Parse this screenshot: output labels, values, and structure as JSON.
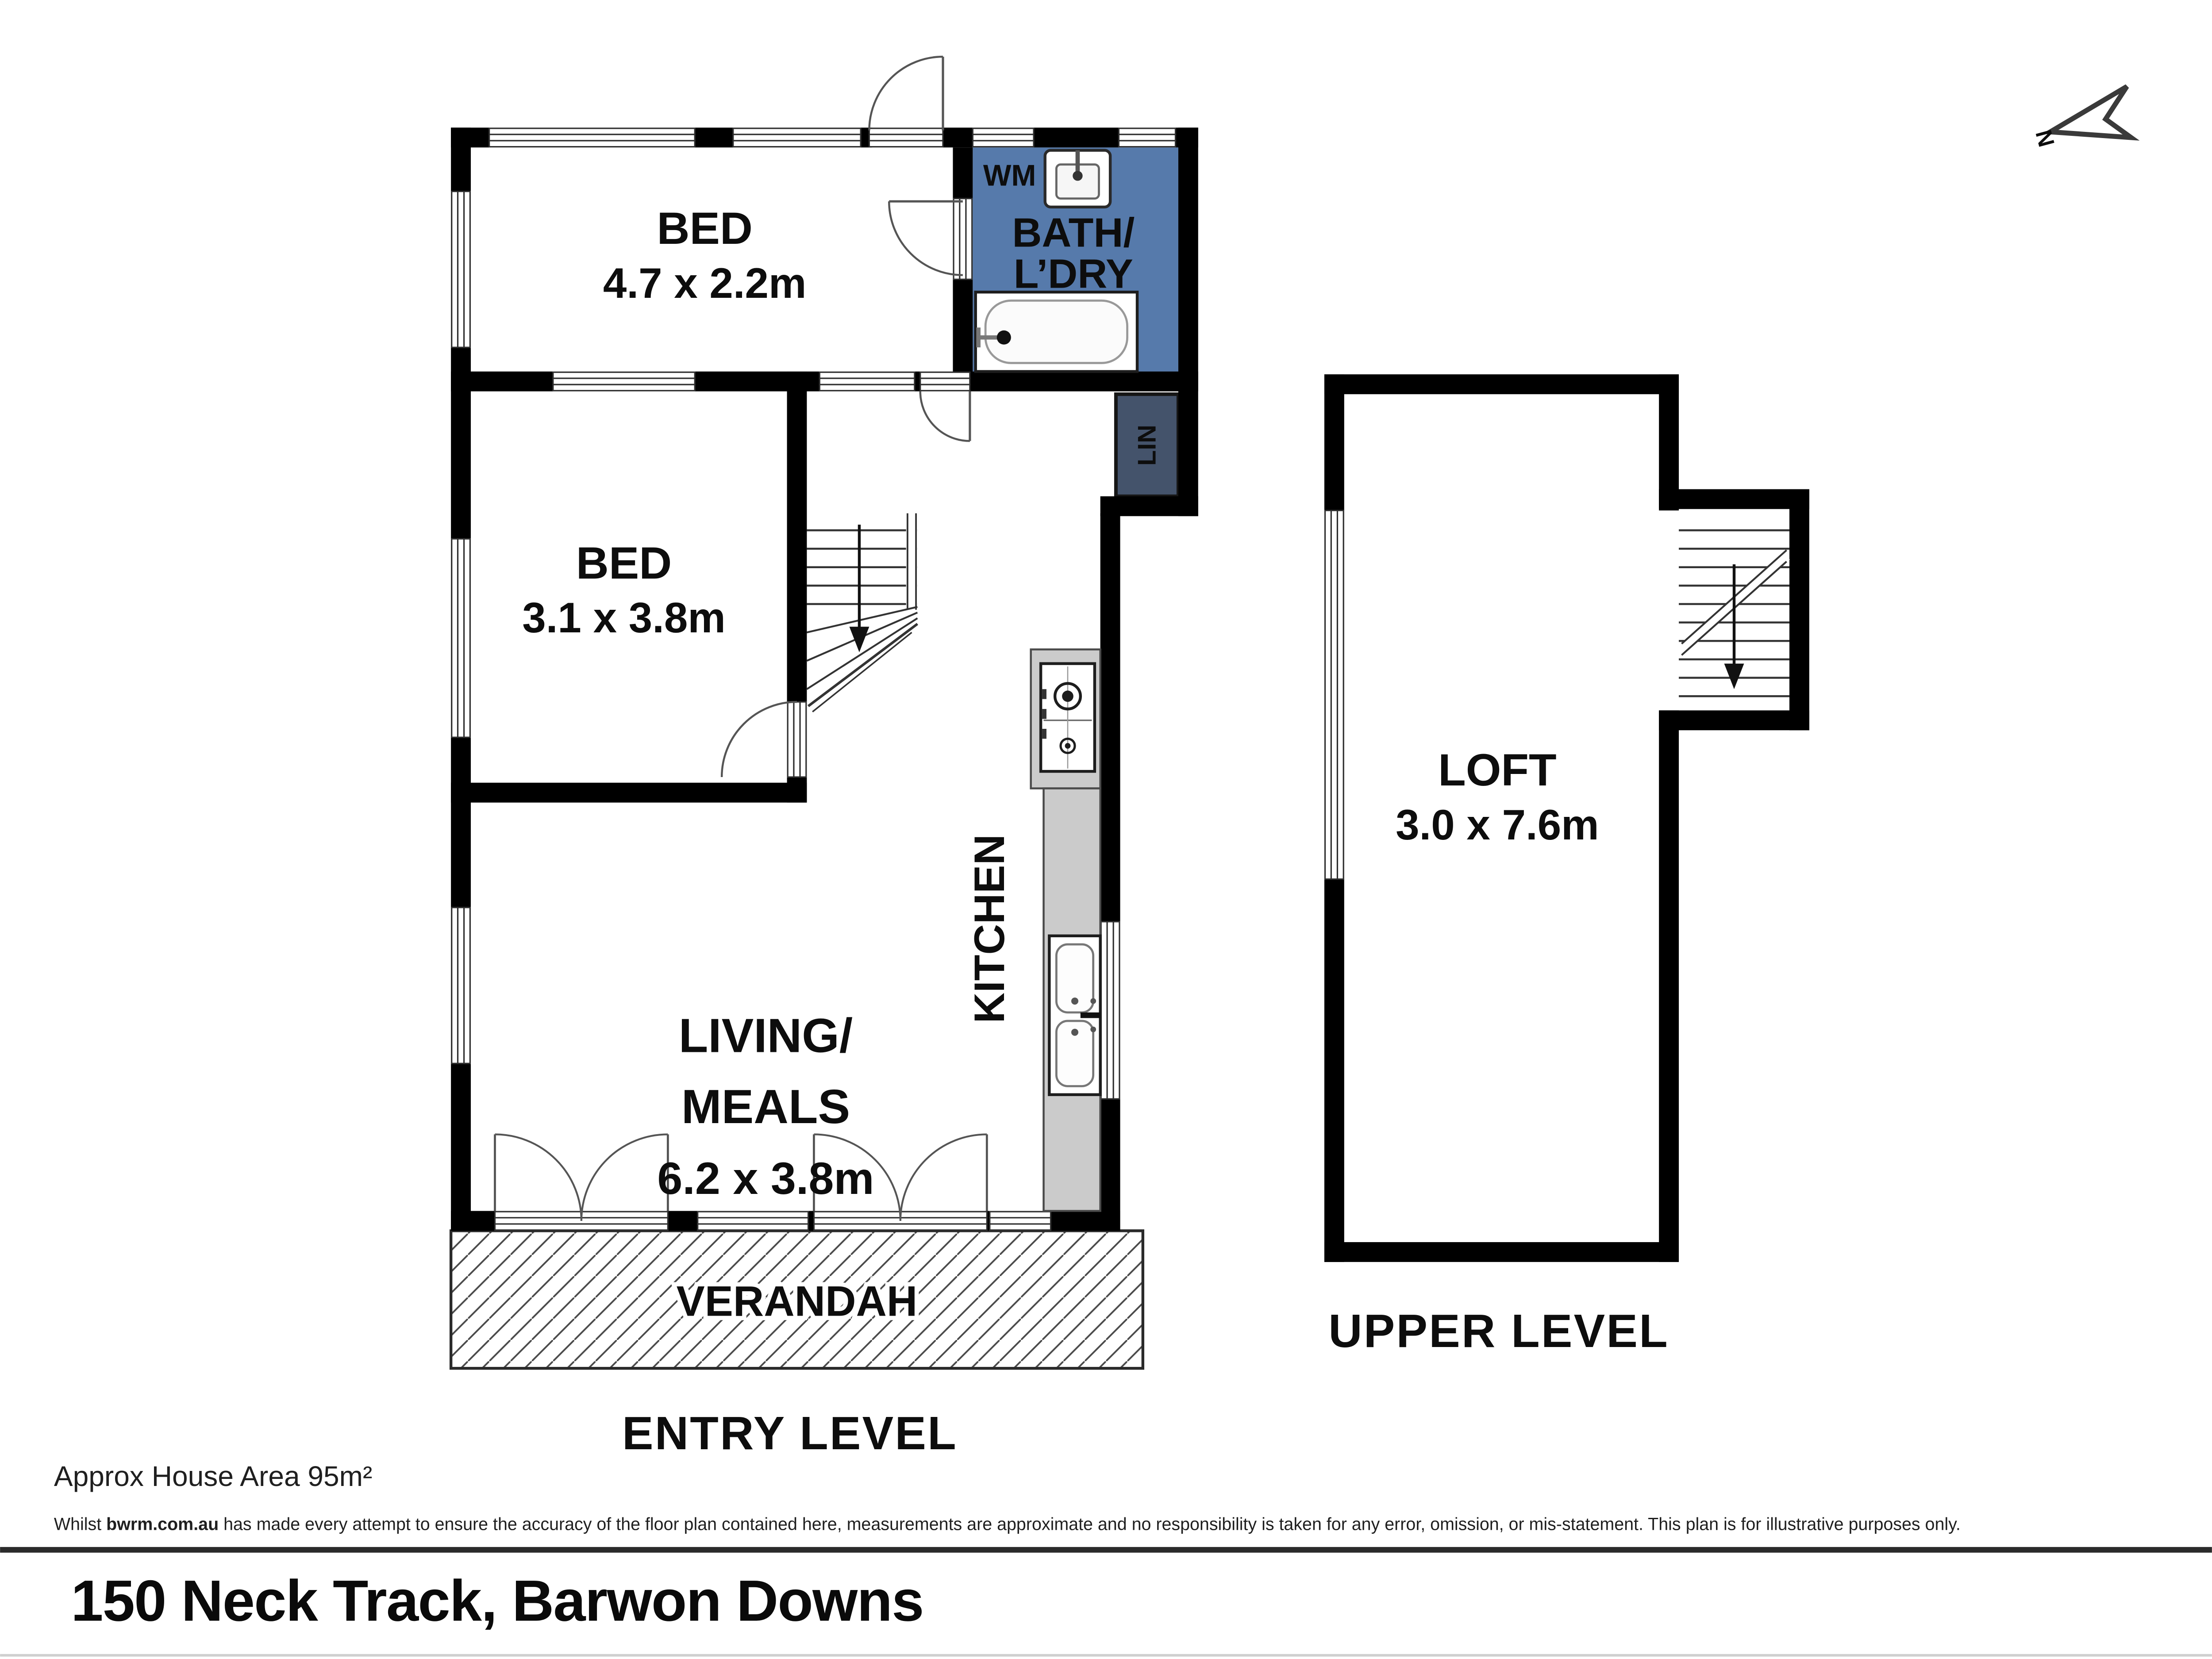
{
  "plan": {
    "compass": {
      "label": "N"
    },
    "entry_level": {
      "title": "ENTRY LEVEL",
      "rooms": {
        "bed1": {
          "label": "BED",
          "dims": "4.7 x 2.2m"
        },
        "bed2": {
          "label": "BED",
          "dims": "3.1 x 3.8m"
        },
        "bath_laundry": {
          "label_line1": "BATH/",
          "label_line2": "L’DRY"
        },
        "living_meals": {
          "label_line1": "LIVING/",
          "label_line2": "MEALS",
          "dims": "6.2 x 3.8m"
        },
        "kitchen": {
          "label": "KITCHEN"
        },
        "linen": {
          "label": "LIN"
        },
        "verandah": {
          "label": "VERANDAH"
        }
      },
      "fixtures": {
        "washing_machine": {
          "label": "WM"
        }
      }
    },
    "upper_level": {
      "title": "UPPER LEVEL",
      "rooms": {
        "loft": {
          "label": "LOFT",
          "dims": "3.0 x 7.6m"
        }
      }
    },
    "colors": {
      "wall": "#000000",
      "bath_floor": "#567aab",
      "linen_floor": "#44536b",
      "bench": "#cbcbcb",
      "hatch_line": "#4a4a4a"
    }
  },
  "footer": {
    "area_note": "Approx House Area 95m²",
    "disclaimer_prefix": "Whilst ",
    "disclaimer_brand": "bwrm.com.au",
    "disclaimer_rest": " has made every attempt to ensure the accuracy of the floor plan contained here, measurements are approximate and no responsibility is taken for any error, omission, or mis-statement. This plan is for illustrative purposes only.",
    "address": "150 Neck Track, Barwon Downs"
  }
}
